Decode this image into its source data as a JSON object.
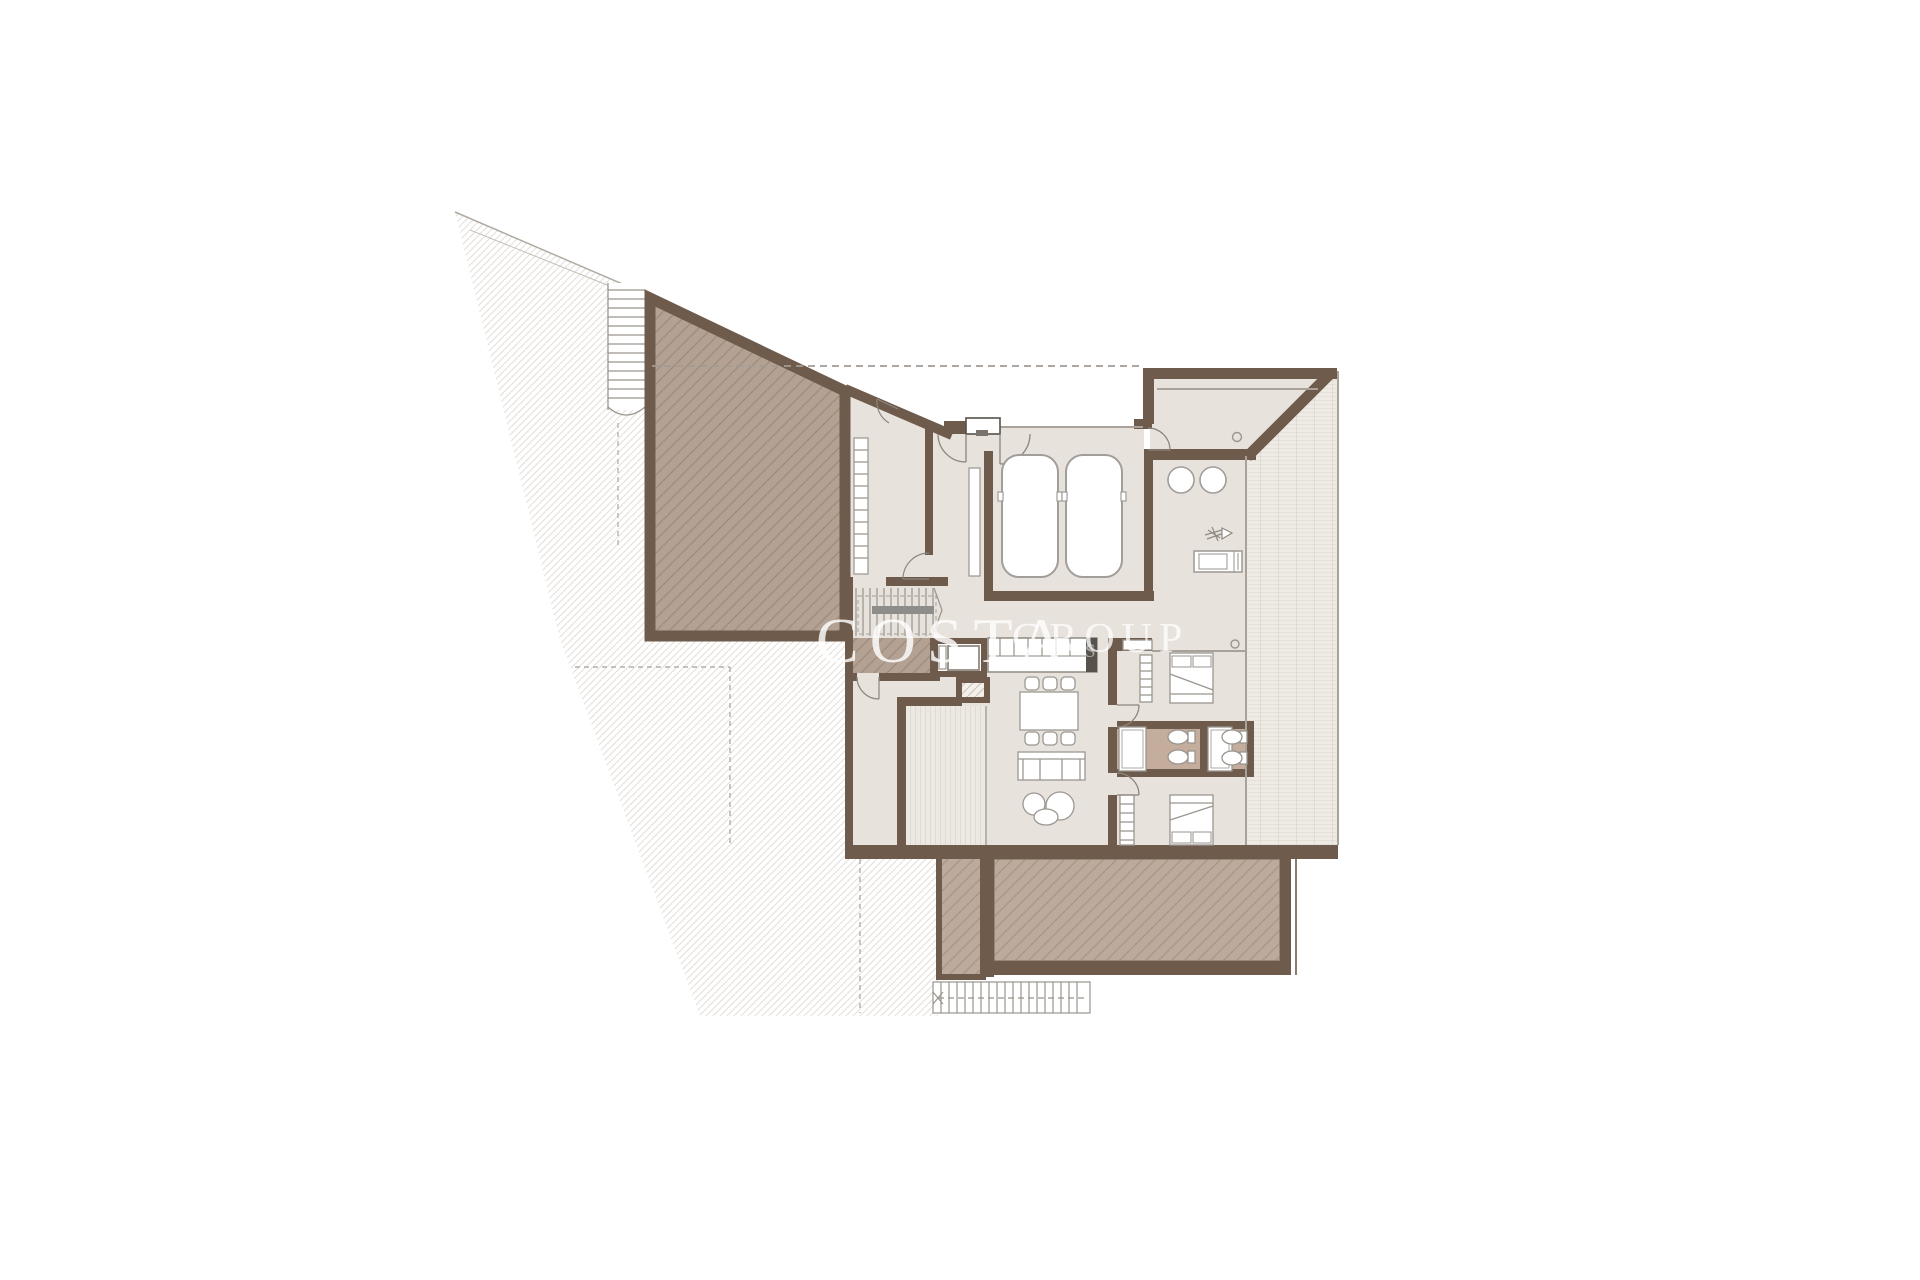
{
  "watermark": {
    "company": "COSTA",
    "suffix": "GROUP",
    "fragment": "S"
  },
  "palette": {
    "wall": "#6e5b4b",
    "interior_floor": "#e7e2dc",
    "roof_terrace_fill": "#b3a293",
    "roof_terrace_hatch": "#a18d7d",
    "deck_fill": "#bcab9c",
    "deck_hatch": "#aa9887",
    "bathroom_floor": "#c4ad9c",
    "tile_bg": "#eeebe5",
    "tile_line": "#d9d2c6",
    "hillside_hatch": "#e4dfd8",
    "furniture_line": "#9b9792",
    "watermark_color": "#ffffff"
  },
  "plan": {
    "type": "residential-floor-plan",
    "rooms": [
      "roof-terrace",
      "dressing-room",
      "entry-hall",
      "garage",
      "entrance-porch",
      "service-patio",
      "staircase",
      "elevator",
      "kitchen",
      "living-dining-room",
      "bedroom-1",
      "bathroom-1",
      "bathroom-2",
      "bedroom-2",
      "tiled-terrace",
      "wood-deck",
      "light-well"
    ],
    "furniture_counts": {
      "cars": 2,
      "beds": 2,
      "dining_chairs": 6,
      "sofas": 1,
      "coffee_tables": 3,
      "toilets": 4,
      "showers": 2,
      "loungers": 1
    }
  }
}
